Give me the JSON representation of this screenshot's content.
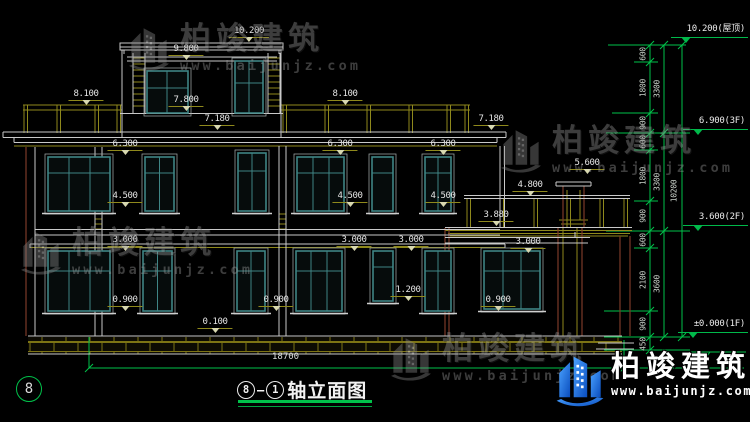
{
  "drawing": {
    "title": {
      "axis_from": "8",
      "dash": "—",
      "axis_to": "1",
      "name": "轴立面图"
    },
    "axis_bubble": "8",
    "overall_width": "18700",
    "facade_marks": [
      "10.200",
      "9.800",
      "8.100",
      "8.100",
      "7.800",
      "7.180",
      "7.180",
      "6.300",
      "6.300",
      "6.300",
      "5.600",
      "4.800",
      "4.500",
      "4.500",
      "4.500",
      "3.880",
      "3.000",
      "3.000",
      "3.000",
      "3.000",
      "1.200",
      "0.900",
      "0.900",
      "0.900",
      "0.100"
    ],
    "right_dims": {
      "small": [
        "600",
        "1800",
        "900",
        "600",
        "1800",
        "900",
        "600",
        "2100",
        "900",
        "450"
      ],
      "mid": [
        "3300",
        "3300",
        "3600"
      ],
      "total": "10200"
    },
    "levels": [
      "10.200(屋顶)",
      "6.900(3F)",
      "3.600(2F)",
      "±0.000(1F)"
    ],
    "colors": {
      "dim_green": "#00c24a",
      "line_white": "#c9c9c9",
      "band_olive": "#8f891c",
      "wall_brown": "#7c3a28",
      "window_teal": "#3f8585",
      "logo_blue": "#1565d8"
    }
  },
  "watermark": {
    "brand": "柏竣建筑",
    "url": "www.baijunjz.com"
  },
  "logo": {
    "brand": "柏竣建筑",
    "url": "www.baijunjz.com"
  }
}
